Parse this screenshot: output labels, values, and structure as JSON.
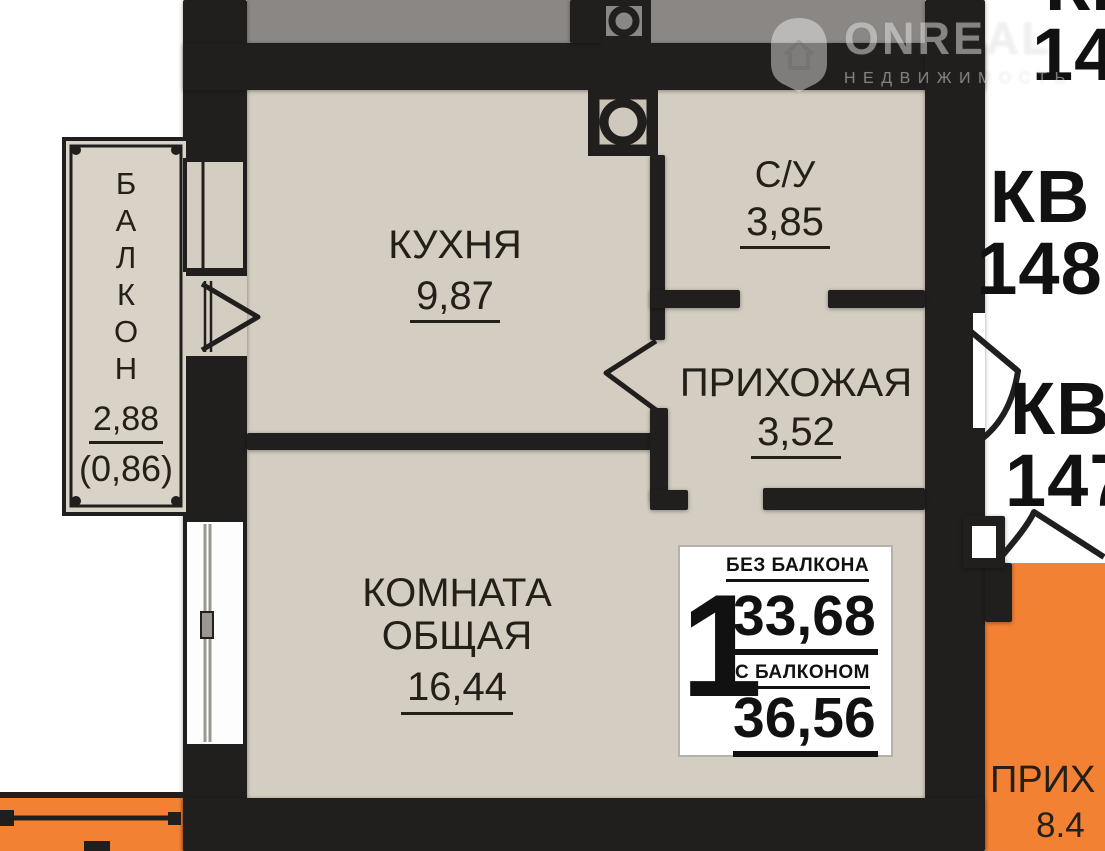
{
  "plan": {
    "balcony": {
      "letters": [
        "Б",
        "А",
        "Л",
        "К",
        "О",
        "Н"
      ],
      "area": "2,88",
      "area_coef": "(0,86)"
    },
    "kitchen": {
      "name": "КУХНЯ",
      "area": "9,87"
    },
    "bathroom": {
      "name": "С/У",
      "area": "3,85"
    },
    "hallway": {
      "name": "ПРИХОЖАЯ",
      "area": "3,52"
    },
    "room": {
      "line1": "КОМНАТА",
      "line2": "ОБЩАЯ",
      "area": "16,44"
    },
    "neighbor_hall": {
      "name": "ПРИХ",
      "area": "8.4"
    }
  },
  "apartments": {
    "top_kv": "КВ",
    "top_num": "14",
    "kv148_label": "КВ",
    "kv148_num": "148",
    "kv147_label": "КВ",
    "kv147_num": "147"
  },
  "summary": {
    "rooms_count": "1",
    "no_balcony_label": "БЕЗ БАЛКОНА",
    "no_balcony_value": "33,68",
    "with_balcony_label": "С БАЛКОНОМ",
    "with_balcony_value": "36,56"
  },
  "watermark": {
    "brand": "ONREAL",
    "tagline": "НЕДВИЖИМОСТЬ"
  },
  "colors": {
    "wall": "#211f1d",
    "room_fill": "#d4cdc1",
    "neighbor_gray": "#8b8784",
    "orange": "#f28134"
  }
}
